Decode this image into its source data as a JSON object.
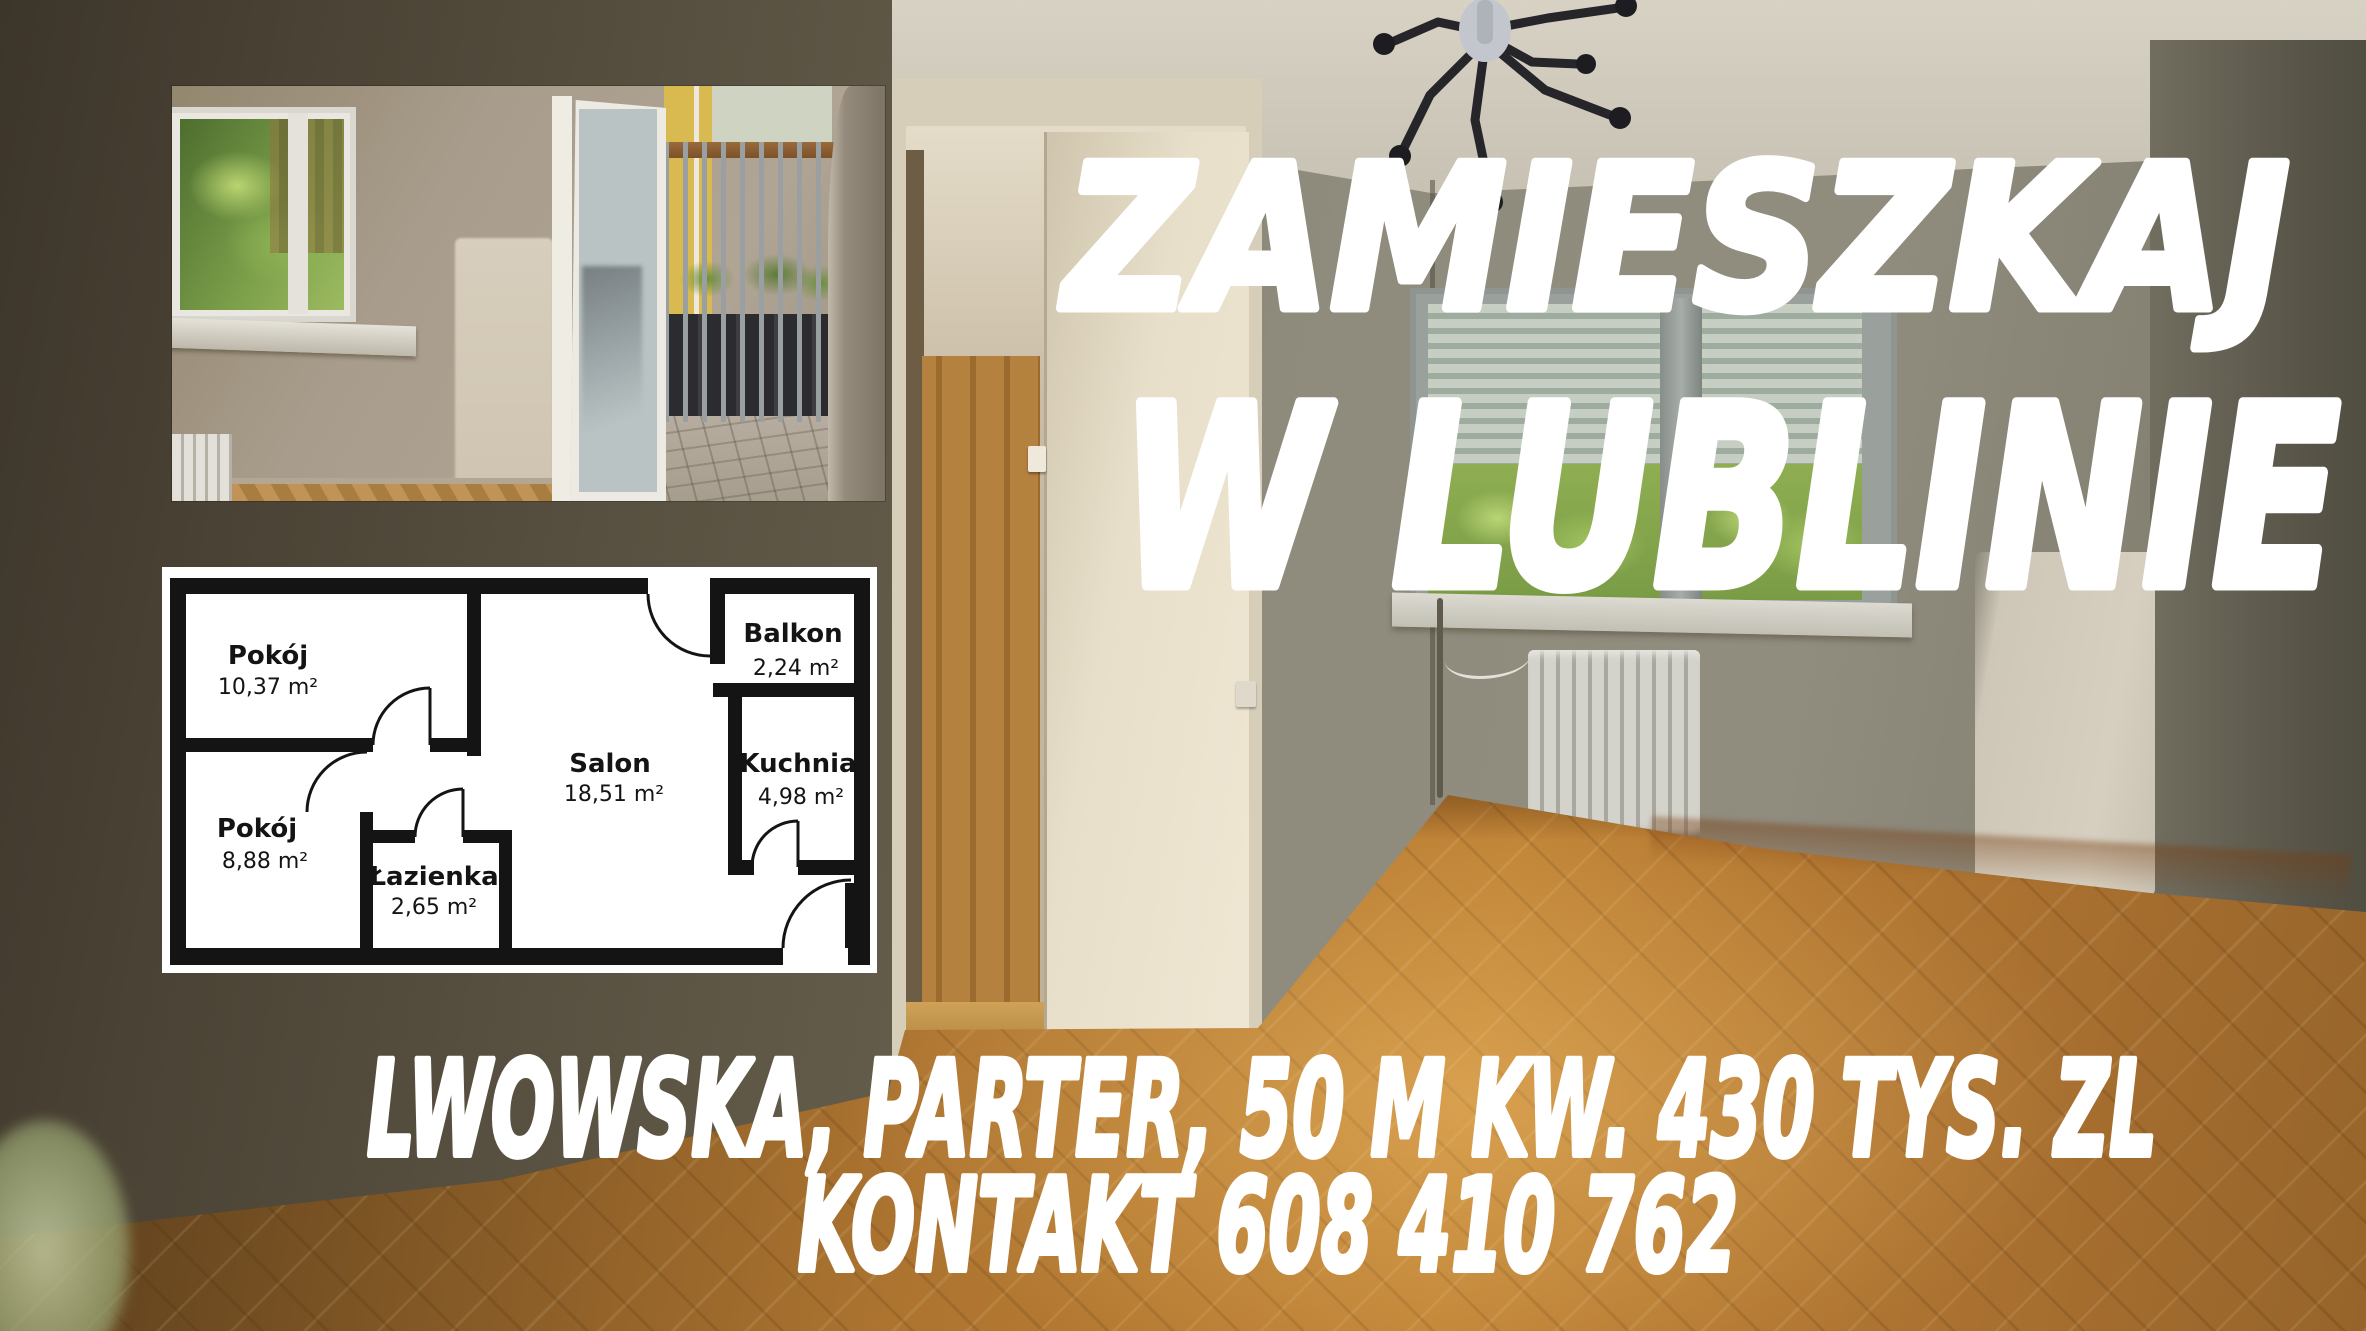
{
  "poster": {
    "headline_line1": "ZAMIESZKAJ",
    "headline_line2": "W LUBLINIE",
    "details_line": "LWOWSKA, PARTER, 50 M KW. 430 TYS. ZL",
    "contact_line": "KONTAKT 608 410 762",
    "text_color": "#ffffff"
  },
  "floor_plan": {
    "background": "#ffffff",
    "wall_color": "#141414",
    "rooms": [
      {
        "name": "Pokój",
        "area": "10,37 m²"
      },
      {
        "name": "Pokój",
        "area": "8,88 m²"
      },
      {
        "name": "Łazienka",
        "area": "2,65 m²"
      },
      {
        "name": "Salon",
        "area": "18,51 m²"
      },
      {
        "name": "Balkon",
        "area": "2,24 m²"
      },
      {
        "name": "Kuchnia",
        "area": "4,98 m²"
      }
    ]
  },
  "photo": {
    "wall_gray": "#8d897b",
    "dark_wall": "#4a4234",
    "floor_wood": "#b5792f",
    "white_patch": "#cec7b8"
  }
}
